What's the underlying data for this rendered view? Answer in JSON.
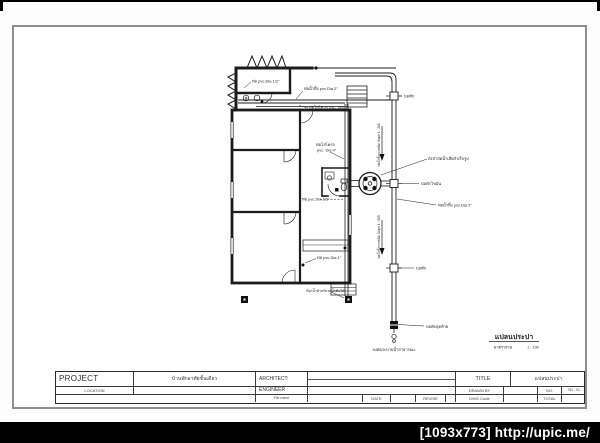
{
  "page": {
    "watermark": "[1093x773] http://upic.me/"
  },
  "colors": {
    "paper": "#ffffff",
    "frame_gray": "#8f8f8f",
    "ink": "#1c1c1c",
    "bar_black": "#000000"
  },
  "plan": {
    "title": "แปลนประปา",
    "scale_label": "มาตราส่วน",
    "scale_value": "1 : 100",
    "labels": {
      "pipe_half_top": "ท่อ pvc.Dia 1/2\"",
      "waste_2in_top": "ท่อน้ำทิ้ง pvc.Dia 2\"",
      "soil_4in_top": "ท่อโสโครก pvc. Dia 4\"",
      "soil_4in_mid_1": "ท่อโสโครก",
      "soil_4in_mid_2": "pvc. Dia 4\"",
      "pipe_half_mid": "ท่อ pvc.Dia 1/2\"",
      "pipe_1in": "ท่อ pvc.Dia 1\"",
      "garden_tap": "ก๊อกน้ำสำหรับรดน้ำต้นไม้",
      "manhole": "บ่อพัก",
      "septic": "ถังบำบัดน้ำเสียสำเร็จรูป",
      "grease": "บ่อดักไขมัน",
      "waste_2in_right": "ท่อน้ำทิ้ง pvc.Dia 2\"",
      "manhole_last": "บ่อพักสุดท้าย",
      "public_drain": "ลงท่อระบายน้ำสาธารณะ",
      "slope_note": "ท่อน้ำทิ้งรวมชนิด Slope 1 : 200"
    }
  },
  "title_block": {
    "project_label": "PROJECT",
    "project_value": "บ้านพักอาศัยชั้นเดียว",
    "location_label": "LOCATION",
    "architect_label": "ARCHITECT:",
    "engineer_label": "ENGINEER",
    "file_name_label": "File name",
    "date_label": "DATE",
    "revise_label": "REVISE",
    "title_label": "TITLE",
    "title_value": "แปลนประปา",
    "drawn_by_label": "DRAWN BY",
    "dwg_code_label": "DWG Code",
    "no_label": "NO.",
    "no_value": "SN - 01",
    "total_label": "TOTAL"
  }
}
